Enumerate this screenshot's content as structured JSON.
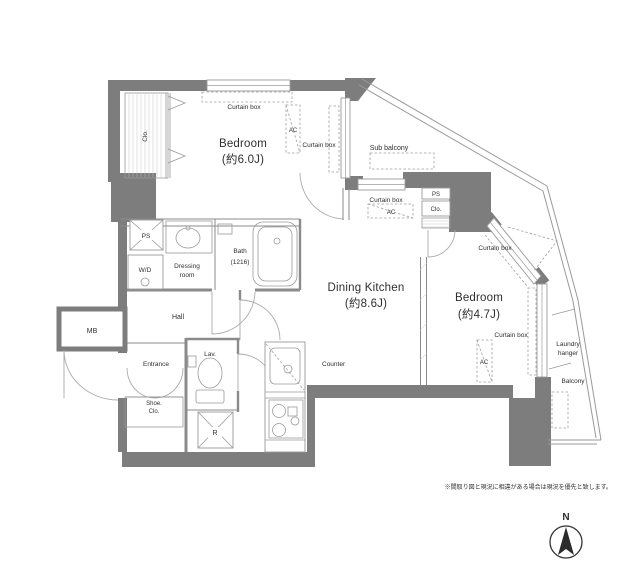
{
  "rooms": {
    "bedroom1": {
      "name": "Bedroom",
      "size": "(約6.0J)"
    },
    "dining_kitchen": {
      "name": "Dining Kitchen",
      "size": "(約8.6J)"
    },
    "bedroom2": {
      "name": "Bedroom",
      "size": "(約4.7J)"
    }
  },
  "labels": {
    "curtain_box": "Curtain box",
    "ac": "AC",
    "ps": "PS",
    "clo": "Clo.",
    "sub_balcony": "Sub balcony",
    "balcony": "Balcony",
    "laundry_line1": "Laundry",
    "laundry_line2": "hanger",
    "wd": "W/D",
    "dressing_line1": "Dressing",
    "dressing_line2": "room",
    "bath_line1": "Bath",
    "bath_line2": "(1216)",
    "hall": "Hall",
    "entrance": "Entrance",
    "shoe_line1": "Shoe.",
    "shoe_line2": "Clo.",
    "lav": "Lav.",
    "refrigerator": "R",
    "mb": "MB",
    "counter": "Counter"
  },
  "compass": {
    "north": "N"
  },
  "note": "※間取り図と現況に相違がある場合は現況を優先と致します。",
  "colors": {
    "wall": "#7d7d7d",
    "line": "#9a9a9a",
    "text": "#2f2f2f"
  }
}
